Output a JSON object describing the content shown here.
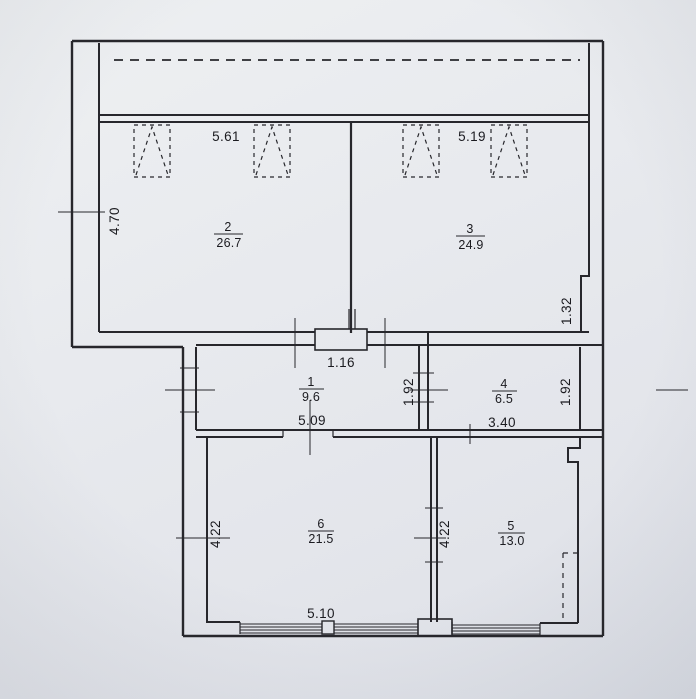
{
  "floorplan": {
    "scan": {
      "paper_color": "#e8eaee",
      "ink_color": "#27272c"
    },
    "rooms": {
      "r1": {
        "number": "1",
        "area": "9.6"
      },
      "r2": {
        "number": "2",
        "area": "26.7"
      },
      "r3": {
        "number": "3",
        "area": "24.9"
      },
      "r4": {
        "number": "4",
        "area": "6.5"
      },
      "r5": {
        "number": "5",
        "area": "13.0"
      },
      "r6": {
        "number": "6",
        "area": "21.5"
      }
    },
    "dimensions": {
      "room2_width": "5.61",
      "room3_width": "5.19",
      "room2_height": "4.70",
      "entry_opening": "1.16",
      "room1_width": "5.09",
      "right_wall_upper": "1.32",
      "room4_height_left": "1.92",
      "room4_height_right": "1.92",
      "room4_width": "3.40",
      "room6_height": "4.22",
      "room5_height": "4.22",
      "room6_width": "5.10"
    }
  }
}
